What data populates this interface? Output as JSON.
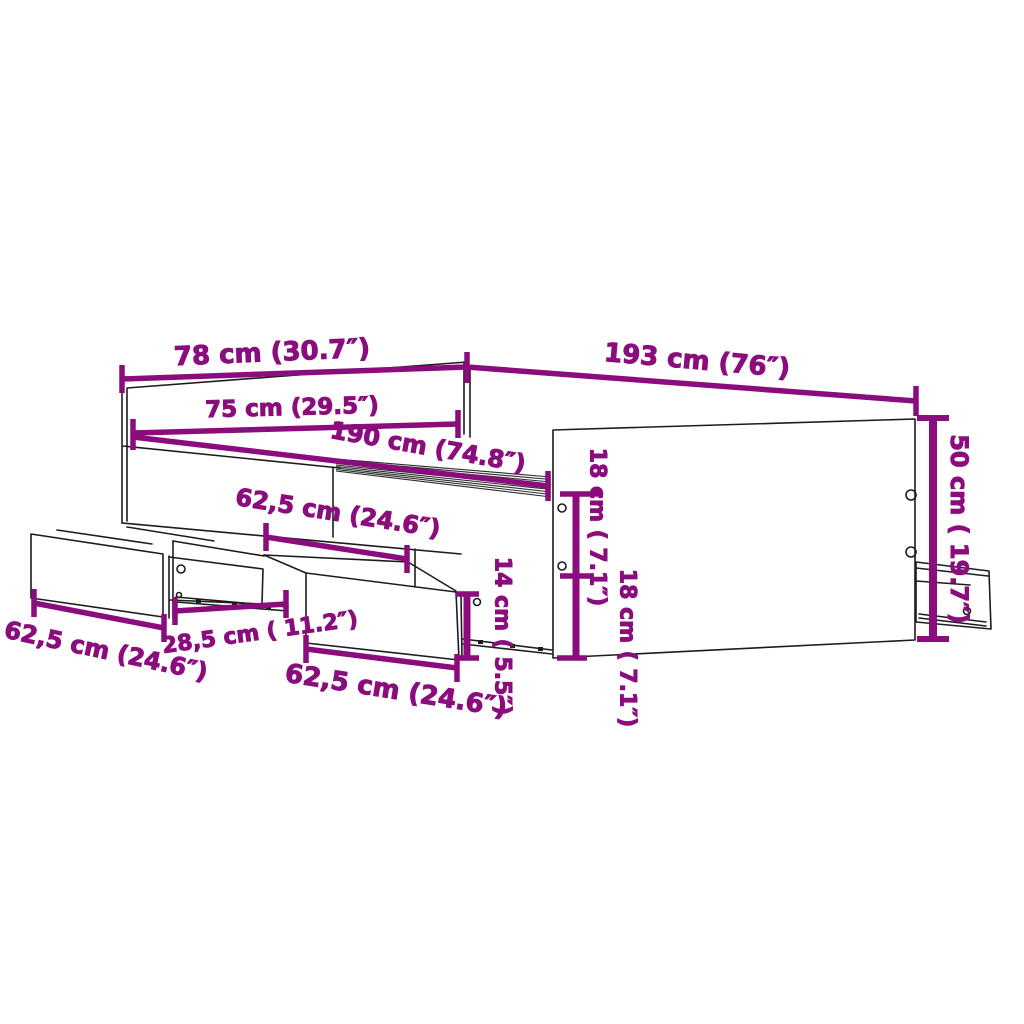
{
  "diagram": {
    "kind": "furniture-dimension-diagram",
    "subject": "bed frame with headboard and storage drawers",
    "background_color": "#ffffff",
    "line_color": "#1c1c1c",
    "dimension_color": "#8b0c7d",
    "dimensions": [
      {
        "id": "headboard-width",
        "label": "78 cm (30.7″)",
        "orientation": "horizontal"
      },
      {
        "id": "frame-length-outer",
        "label": "193 cm (76″)",
        "orientation": "horizontal"
      },
      {
        "id": "headboard-inner-width",
        "label": "75 cm (29.5″)",
        "orientation": "horizontal"
      },
      {
        "id": "frame-length-inner",
        "label": "190 cm (74.8″)",
        "orientation": "horizontal"
      },
      {
        "id": "drawer-opening-width",
        "label": "62,5 cm (24.6″)",
        "orientation": "horizontal"
      },
      {
        "id": "left-drawer-width",
        "label": "62,5 cm (24.6″)",
        "orientation": "horizontal"
      },
      {
        "id": "drawer-depth",
        "label": "28,5 cm ( 11.2″)",
        "orientation": "horizontal"
      },
      {
        "id": "center-drawer-width",
        "label": "62,5 cm (24.6″)",
        "orientation": "horizontal"
      },
      {
        "id": "drawer-front-height",
        "label": "14 cm ( 5.5″)",
        "orientation": "vertical"
      },
      {
        "id": "side-rail-upper-height",
        "label": "18 cm ( 7.1″)",
        "orientation": "vertical"
      },
      {
        "id": "side-rail-lower-height",
        "label": "18 cm ( 7.1″)",
        "orientation": "vertical"
      },
      {
        "id": "frame-height",
        "label": "50 cm ( 19.7″)",
        "orientation": "vertical"
      }
    ]
  }
}
